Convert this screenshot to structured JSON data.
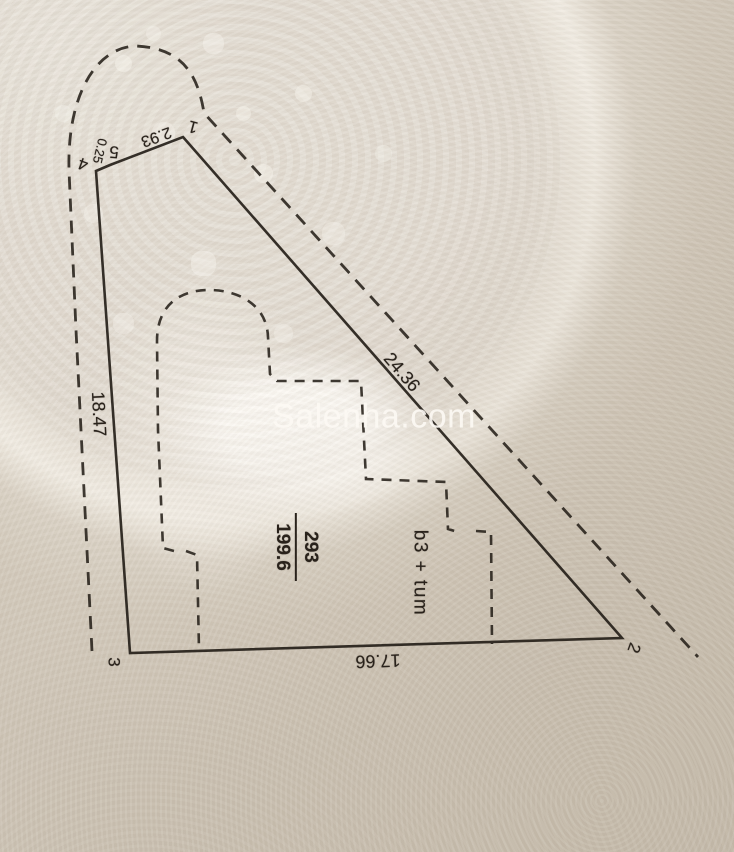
{
  "watermark": {
    "text": "Salenha.com"
  },
  "survey": {
    "points": [
      {
        "text": "1"
      },
      {
        "text": "2"
      },
      {
        "text": "3"
      },
      {
        "text": "4"
      },
      {
        "text": "5"
      }
    ],
    "dimensions": {
      "edge_5_1": "2.93",
      "edge_4_5": "0.25",
      "edge_1_2": "24.36",
      "edge_3_4": "18.47",
      "edge_2_3": "17.66"
    },
    "parcel": {
      "number": "293",
      "area": "199.6"
    },
    "building": {
      "label": "b3 + tum"
    }
  },
  "colors": {
    "ink": "#29221b",
    "paper_light": "#e5dfd5",
    "paper_dark": "#cfc6b8",
    "watermark_text": "#fcf9f3"
  }
}
